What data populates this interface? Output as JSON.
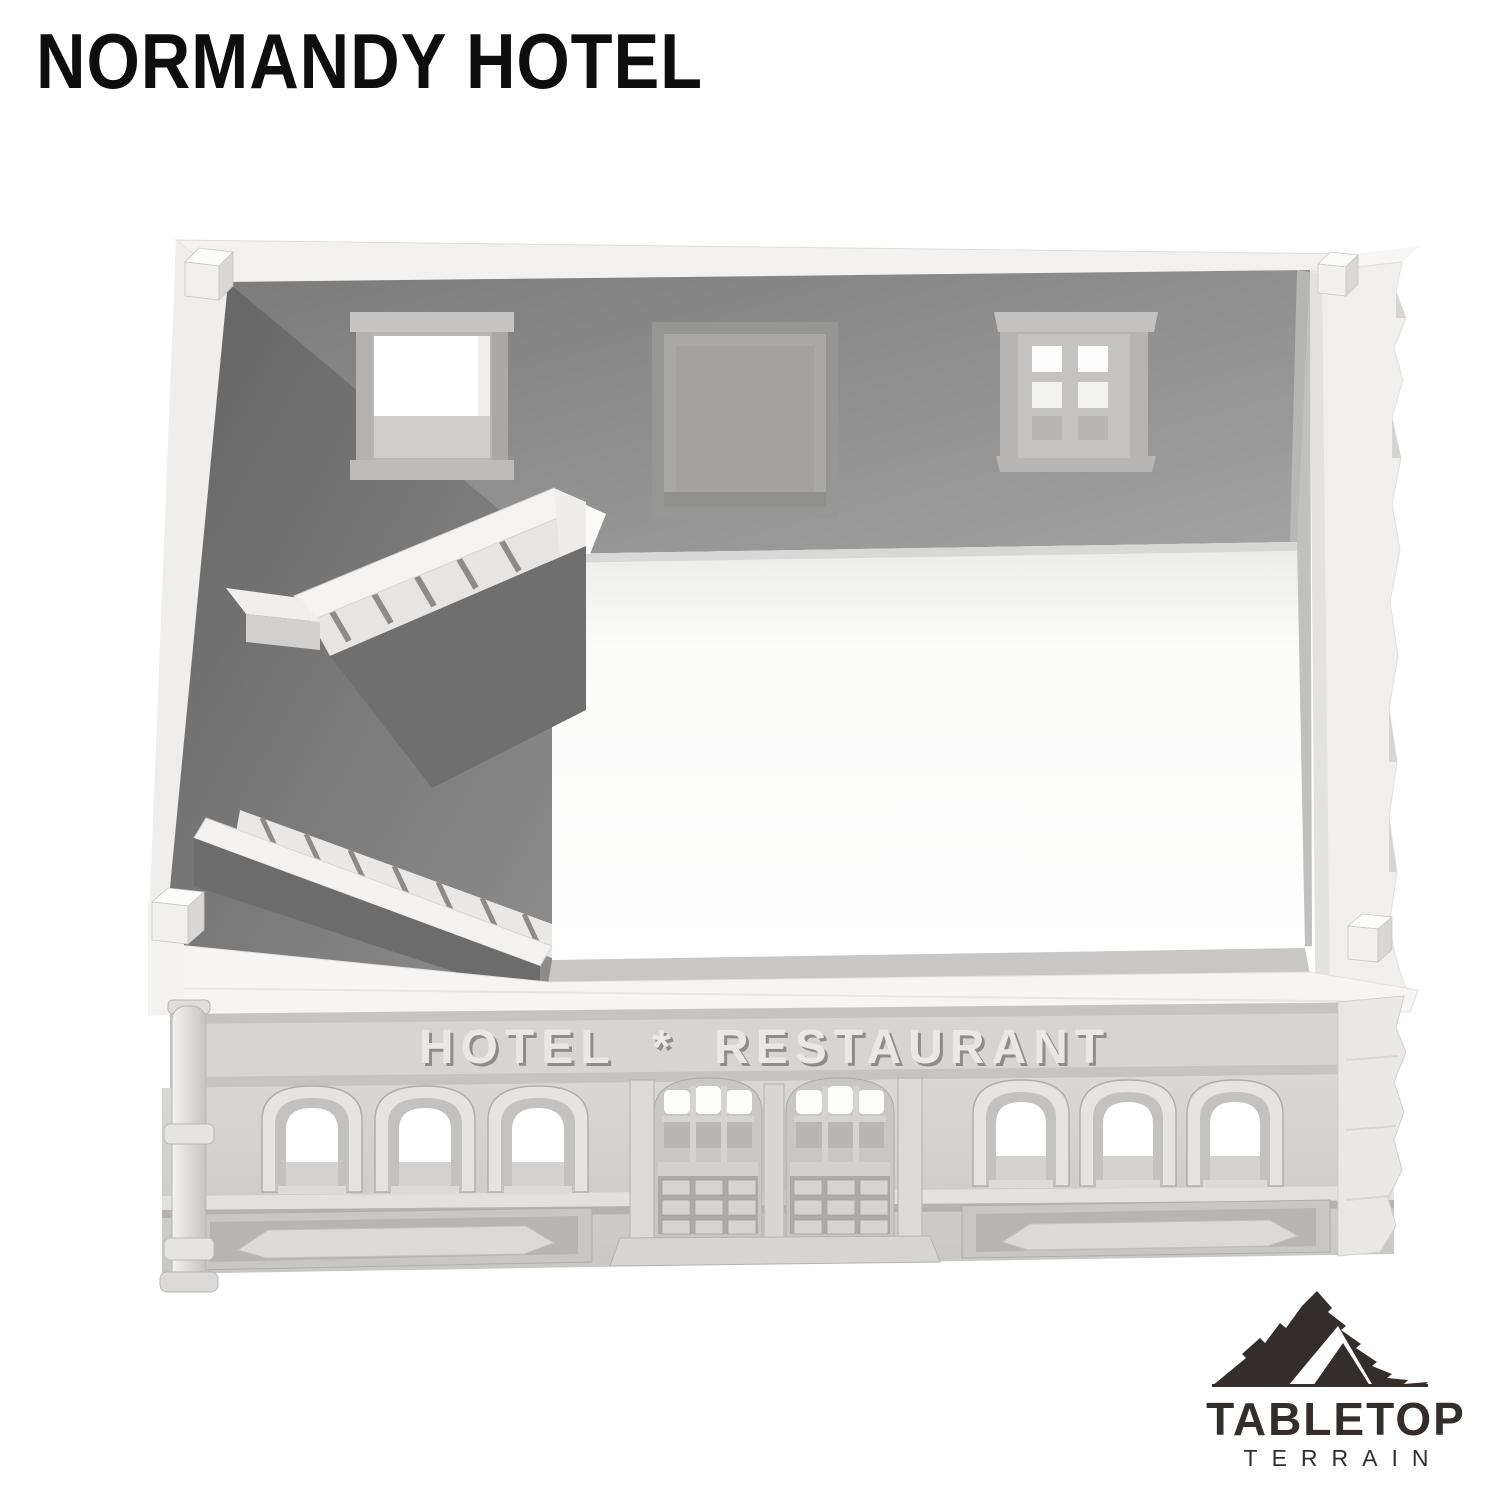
{
  "page": {
    "background": "#ffffff",
    "title": "NORMANDY HOTEL"
  },
  "product": {
    "signage": "HOTEL * RESTAURANT"
  },
  "logo": {
    "icon": "mountain-icon",
    "name": "TABLETOP",
    "subtitle": "TERRAIN",
    "color": "#332e2b"
  },
  "colors": {
    "title_text": "#0e0e0e",
    "sign_letters": "#e9e8e7",
    "interior_wall": "#8f8f8f",
    "interior_wall_dark": "#6f6f6f",
    "facade": "#d4d2cf",
    "exterior_white": "#f4f3f1"
  }
}
